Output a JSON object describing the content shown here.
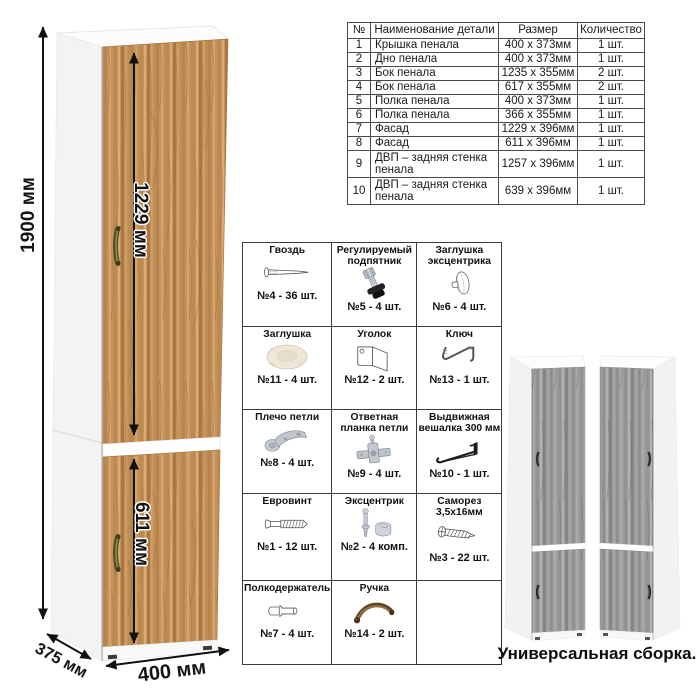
{
  "dimensions": {
    "height": "1900 мм",
    "upper_door": "1229 мм",
    "lower_door": "611 мм",
    "width": "400 мм",
    "depth": "375 мм"
  },
  "parts_table": {
    "headers": [
      "№",
      "Наименование детали",
      "Размер",
      "Количество"
    ],
    "rows": [
      [
        "1",
        "Крышка пенала",
        "400 x 373мм",
        "1 шт."
      ],
      [
        "2",
        "Дно пенала",
        "400 x 373мм",
        "1 шт."
      ],
      [
        "3",
        "Бок пенала",
        "1235 x 355мм",
        "2 шт."
      ],
      [
        "4",
        "Бок пенала",
        "617 x 355мм",
        "2 шт."
      ],
      [
        "5",
        "Полка пенала",
        "400 x 373мм",
        "1 шт."
      ],
      [
        "6",
        "Полка пенала",
        "366 x 355мм",
        "1 шт."
      ],
      [
        "7",
        "Фасад",
        "1229 x 396мм",
        "1 шт."
      ],
      [
        "8",
        "Фасад",
        "611 x 396мм",
        "1 шт."
      ],
      [
        "9",
        "ДВП – задняя стенка пенала",
        "1257 x 396мм",
        "1 шт."
      ],
      [
        "10",
        "ДВП – задняя стенка пенала",
        "639 x 396мм",
        "1 шт."
      ]
    ]
  },
  "hardware_items": [
    {
      "name": "Гвоздь",
      "count": "№4 - 36 шт.",
      "icon": "nail-icon"
    },
    {
      "name": "Регулируемый подпятник",
      "count": "№5 - 4 шт.",
      "icon": "adjustable-foot-icon"
    },
    {
      "name": "Заглушка эксцентрика",
      "count": "№6 - 4 шт.",
      "icon": "cam-cap-icon"
    },
    {
      "name": "Заглушка",
      "count": "№11 - 4 шт.",
      "icon": "plug-icon"
    },
    {
      "name": "Уголок",
      "count": "№12 - 2 шт.",
      "icon": "corner-bracket-icon"
    },
    {
      "name": "Ключ",
      "count": "№13 - 1 шт.",
      "icon": "hex-key-icon"
    },
    {
      "name": "Плечо петли",
      "count": "№8 - 4 шт.",
      "icon": "hinge-arm-icon"
    },
    {
      "name": "Ответная планка петли",
      "count": "№9 - 4 шт.",
      "icon": "hinge-plate-icon"
    },
    {
      "name": "Выдвижная вешалка 300 мм",
      "count": "№10 - 1 шт.",
      "icon": "pullout-hanger-icon"
    },
    {
      "name": "Евровинт",
      "count": "№1 - 12 шт.",
      "icon": "confirmat-screw-icon"
    },
    {
      "name": "Эксцентрик",
      "count": "№2 - 4 комп.",
      "icon": "cam-lock-icon"
    },
    {
      "name": "Саморез 3,5х16мм",
      "count": "№3 - 22 шт.",
      "icon": "self-tapping-screw-icon"
    },
    {
      "name": "Полкодержатель",
      "count": "№7 - 4 шт.",
      "icon": "shelf-pin-icon"
    },
    {
      "name": "Ручка",
      "count": "№14 - 2 шт.",
      "icon": "handle-icon"
    }
  ],
  "footer_note": "Универсальная сборка.",
  "colors": {
    "wood": "#c6935c",
    "gray_wood": "#9d9d9d",
    "dimension_arrow": "#111111",
    "handle_bronze": "#4f4f27"
  }
}
